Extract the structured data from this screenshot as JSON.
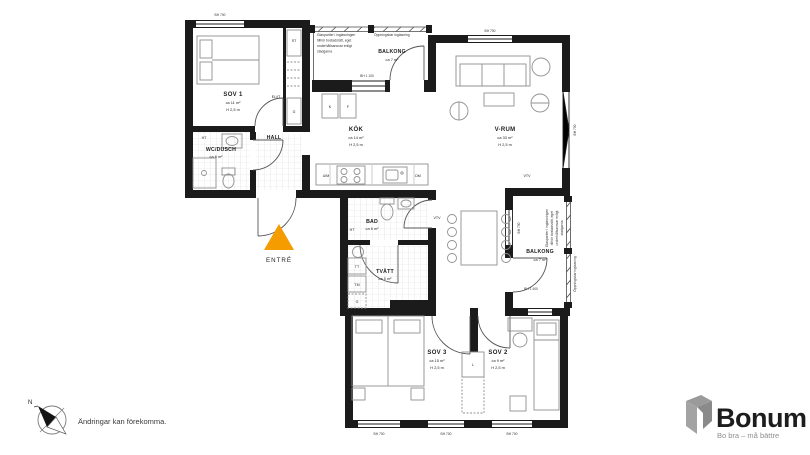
{
  "plan": {
    "rooms": {
      "sov1": {
        "name": "SOV 1",
        "area": "ca 11 m²",
        "height": "H 2,5 m"
      },
      "wc_dusch": {
        "name": "WC/DUSCH",
        "area": "ca 6 m²"
      },
      "hall": {
        "name": "HALL"
      },
      "el_it": {
        "name": "EL/IT"
      },
      "kok": {
        "name": "KÖK",
        "area": "ca 14 m²",
        "height": "H 2,5 m"
      },
      "vrum": {
        "name": "V-RUM",
        "area": "ca 33 m²",
        "height": "H 2,5 m"
      },
      "bad": {
        "name": "BAD",
        "area": "ca 6 m²"
      },
      "tvatt": {
        "name": "TVÄTT",
        "area": "ca 5 m²"
      },
      "sov3": {
        "name": "SOV 3",
        "area": "ca 15 m²",
        "height": "H 2,5 m"
      },
      "sov2": {
        "name": "SOV 2",
        "area": "ca 9 m²",
        "height": "H 2,5 m"
      },
      "balkong_top": {
        "name": "BALKONG",
        "area": "ca 7 m²"
      },
      "balkong_right": {
        "name": "BALKONG",
        "area": "ca 7 m²"
      }
    },
    "fixtures": {
      "ht": "HT",
      "st": "ST",
      "g": "G",
      "k": "K",
      "f": "F",
      "um": "U/M",
      "dm": "DM",
      "fs": "FS",
      "vtv": "VTV",
      "tt": "TT",
      "tm": "TM",
      "l": "L"
    },
    "windows": {
      "bh700": "BH 700",
      "bh1100": "BH 1 100",
      "bh1400": "BH 1 400"
    },
    "entrance": {
      "label": "ENTRÉ",
      "arrow_color": "#F59C00"
    },
    "notes": {
      "glazing_lines": [
        "Glaspartier i inglasningen",
        "tillhör bostadsrätt, eget",
        "underhållsansvar enligt",
        "stadgarna"
      ],
      "openable": "Öppningsbar inglasning"
    },
    "compass_label": "N"
  },
  "footer": {
    "disclaimer": "Ändringar kan förekomma."
  },
  "logo": {
    "brand": "Bonum",
    "tagline": "Bo bra – må bättre",
    "brand_color": "#F07E00",
    "icon_color": "#9A9A9A"
  }
}
